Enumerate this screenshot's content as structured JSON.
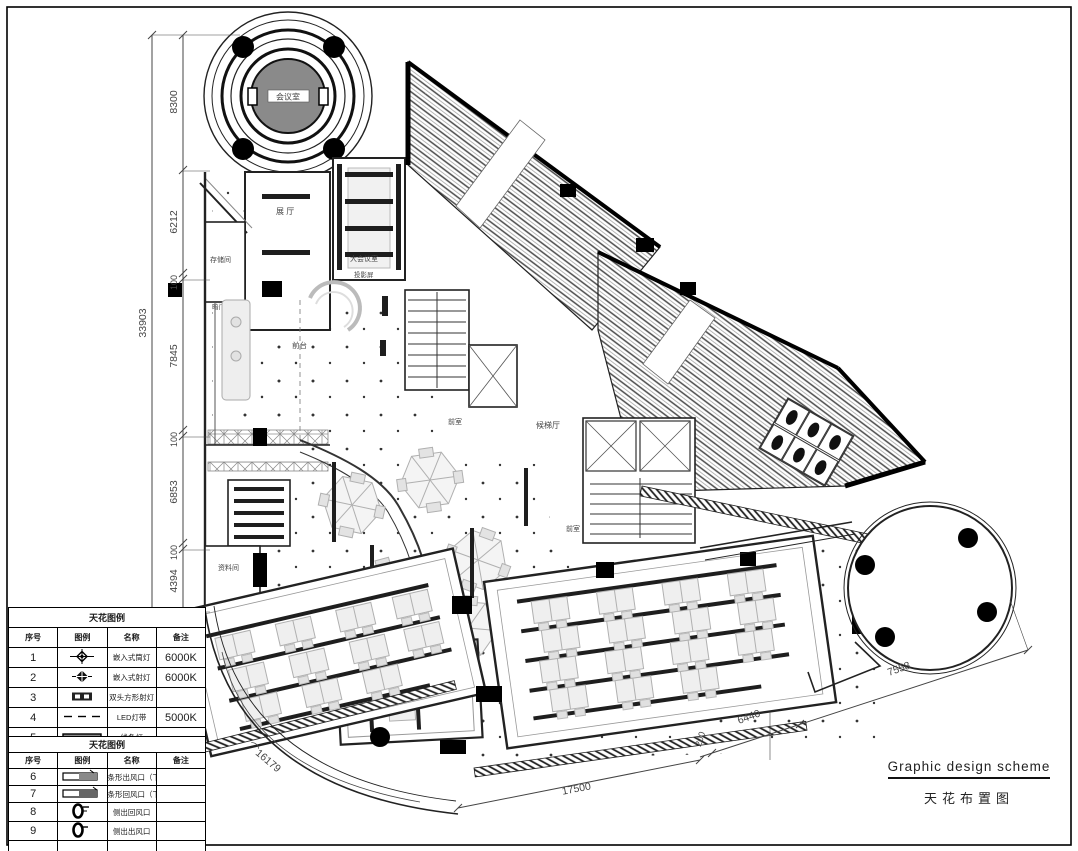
{
  "title_block": {
    "en": "Graphic design scheme",
    "zh": "天花布置图"
  },
  "rooms": {
    "meeting": "会议室",
    "exhibition": "展 厅",
    "storage": "存储间",
    "hidden_door": "暗门",
    "reception": "前台",
    "big_meeting": "大会议室",
    "projection": "投影屏",
    "anteroom1": "前室",
    "lobby": "候梯厅",
    "anteroom2": "前室",
    "archive": "资料间",
    "gm_office": "总经理室"
  },
  "dims": {
    "total_left": "33903",
    "left": [
      "8300",
      "6212",
      "100",
      "7845",
      "100",
      "6853",
      "100",
      "4394"
    ],
    "bottom": [
      "17500",
      "200",
      "6440",
      "7558"
    ],
    "arc": "⌒16179"
  },
  "legend_ceiling": {
    "title": "天花图例",
    "headers": [
      "序号",
      "图例",
      "名称",
      "备注"
    ],
    "rows": [
      {
        "no": "1",
        "symbol": "recessed-downlight",
        "name": "嵌入式筒灯",
        "note": "6000K"
      },
      {
        "no": "2",
        "symbol": "recessed-spotlight",
        "name": "嵌入式射灯",
        "note": "6000K"
      },
      {
        "no": "3",
        "symbol": "double-square-spotlight",
        "name": "双头方形射灯",
        "note": ""
      },
      {
        "no": "4",
        "symbol": "led-strip",
        "name": "LED灯带",
        "note": "5000K"
      },
      {
        "no": "5",
        "symbol": "linear-light",
        "name": "线条灯",
        "note": ""
      }
    ]
  },
  "legend_hvac": {
    "title": "天花图例",
    "headers": [
      "序号",
      "图例",
      "名称",
      "备注"
    ],
    "rows": [
      {
        "no": "6",
        "symbol": "bar-supply-vent",
        "name": "条形出风口（下出风）",
        "note": ""
      },
      {
        "no": "7",
        "symbol": "bar-return-vent",
        "name": "条形回风口（下回风）",
        "note": ""
      },
      {
        "no": "8",
        "symbol": "side-return-vent",
        "name": "侧出回风口",
        "note": ""
      },
      {
        "no": "9",
        "symbol": "side-supply-vent",
        "name": "侧出出风口",
        "note": ""
      }
    ]
  },
  "colors": {
    "ink": "#1a1a1a",
    "furniture": "#bcbcbc",
    "bar": "#1e1e1e",
    "hatch": "#555",
    "center_fill": "#8a8a8a"
  }
}
